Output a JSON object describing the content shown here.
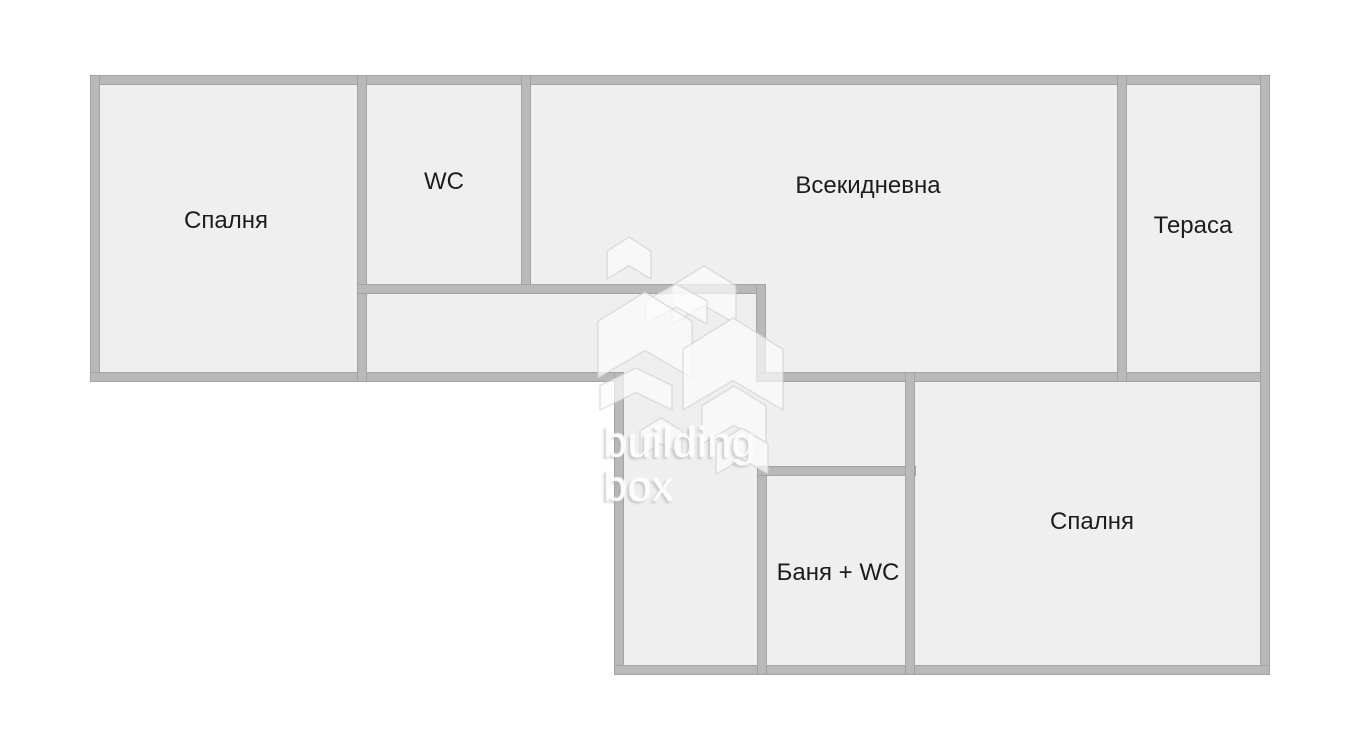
{
  "canvas": {
    "width": 1352,
    "height": 740,
    "background": "#ffffff"
  },
  "palette": {
    "room_fill": "#efefef",
    "wall_fill": "#b9b9b9",
    "wall_edge": "#a3a3a3",
    "label_color": "#1c1c1c",
    "watermark_house_fill": "rgba(252,252,252,0.7)",
    "watermark_house_stroke": "rgba(205,205,205,0.6)",
    "watermark_text_fill": "rgba(253,253,253,0.92)",
    "watermark_text_shadow": "rgba(168,168,168,0.55)"
  },
  "regions": [
    {
      "name": "upper-band-floor",
      "x": 90,
      "y": 75,
      "w": 1180,
      "h": 307
    },
    {
      "name": "lower-band-floor",
      "x": 614,
      "y": 372,
      "w": 656,
      "h": 303
    }
  ],
  "walls": [
    {
      "name": "outer-wall-top",
      "x": 90,
      "y": 75,
      "w": 1180,
      "h": 10
    },
    {
      "name": "outer-wall-left",
      "x": 90,
      "y": 75,
      "w": 10,
      "h": 307
    },
    {
      "name": "outer-wall-bottom-upper",
      "x": 90,
      "y": 372,
      "w": 533,
      "h": 10
    },
    {
      "name": "bedroom1-right-wall",
      "x": 357,
      "y": 75,
      "w": 10,
      "h": 307
    },
    {
      "name": "wc-right-wall",
      "x": 521,
      "y": 75,
      "w": 10,
      "h": 219
    },
    {
      "name": "corridor-top-wall",
      "x": 357,
      "y": 284,
      "w": 409,
      "h": 10
    },
    {
      "name": "living-lower-left-wall",
      "x": 756,
      "y": 284,
      "w": 10,
      "h": 98
    },
    {
      "name": "mid-horizontal-wall",
      "x": 756,
      "y": 372,
      "w": 514,
      "h": 10
    },
    {
      "name": "terrace-divider-wall",
      "x": 1117,
      "y": 75,
      "w": 10,
      "h": 307
    },
    {
      "name": "outer-wall-right",
      "x": 1260,
      "y": 75,
      "w": 10,
      "h": 600
    },
    {
      "name": "lower-band-left-wall",
      "x": 614,
      "y": 372,
      "w": 10,
      "h": 303
    },
    {
      "name": "outer-wall-bottom",
      "x": 614,
      "y": 665,
      "w": 656,
      "h": 10
    },
    {
      "name": "bathroom-left-wall",
      "x": 757,
      "y": 466,
      "w": 10,
      "h": 209
    },
    {
      "name": "bathroom-top-wall",
      "x": 757,
      "y": 466,
      "w": 159,
      "h": 10
    },
    {
      "name": "bathroom-right-wall",
      "x": 905,
      "y": 372,
      "w": 10,
      "h": 303
    }
  ],
  "rooms": [
    {
      "id": "bedroom-top-left",
      "label": "Спалня",
      "cx": 226,
      "cy": 221
    },
    {
      "id": "wc",
      "label": "WC",
      "cx": 444,
      "cy": 182
    },
    {
      "id": "living-room",
      "label": "Всекидневна",
      "cx": 868,
      "cy": 186
    },
    {
      "id": "terrace",
      "label": "Тераса",
      "cx": 1193,
      "cy": 226
    },
    {
      "id": "bathroom-wc",
      "label": "Баня + WC",
      "cx": 838,
      "cy": 573
    },
    {
      "id": "bedroom-bottom-right",
      "label": "Спалня",
      "cx": 1092,
      "cy": 522
    }
  ],
  "watermark": {
    "line1": "building",
    "line2": "box",
    "logo_box": {
      "x": 588,
      "y": 225,
      "w": 200,
      "h": 260
    },
    "houses": [
      {
        "type": "house",
        "x": 607,
        "y": 237,
        "w": 44,
        "h": 42
      },
      {
        "type": "house",
        "x": 672,
        "y": 266,
        "w": 64,
        "h": 58
      },
      {
        "type": "chevron",
        "x": 645,
        "y": 284,
        "w": 62,
        "h": 40
      },
      {
        "type": "house",
        "x": 598,
        "y": 292,
        "w": 94,
        "h": 86
      },
      {
        "type": "house",
        "x": 683,
        "y": 318,
        "w": 100,
        "h": 92
      },
      {
        "type": "chevron",
        "x": 600,
        "y": 368,
        "w": 72,
        "h": 42
      },
      {
        "type": "house",
        "x": 702,
        "y": 386,
        "w": 64,
        "h": 58
      },
      {
        "type": "house",
        "x": 640,
        "y": 418,
        "w": 42,
        "h": 38
      },
      {
        "type": "house",
        "x": 716,
        "y": 428,
        "w": 52,
        "h": 46
      }
    ]
  }
}
